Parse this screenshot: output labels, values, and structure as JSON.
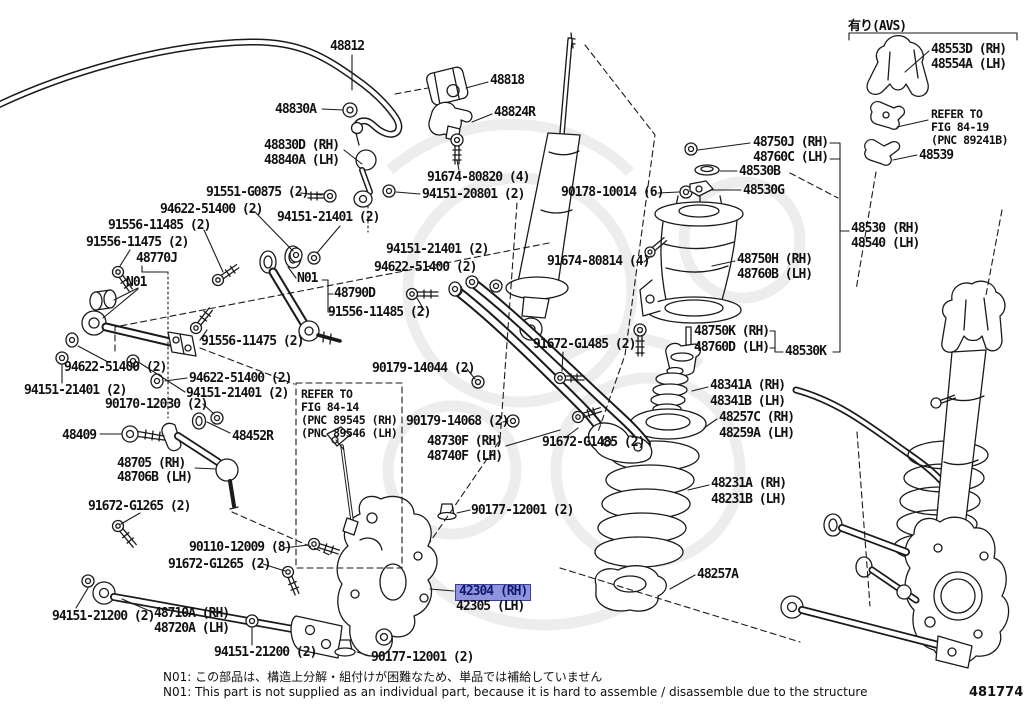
{
  "diagram": {
    "code": "481774G",
    "avs_tag": "有り(AVS)",
    "notes": {
      "jp": "N01: この部品は、構造上分解・組付けが困難なため、単品では補給していません",
      "en": "N01: This part is not supplied as an individual part, because it is hard to assemble / disassemble due to the structure"
    },
    "colors": {
      "line": "#1a1a1a",
      "watermark": "#ededed",
      "highlight_bg": "#8f95dc",
      "highlight_border": "#3a3f9f",
      "highlight_text": "#101870"
    },
    "highlighted_part": "42304 (RH)",
    "labels": [
      {
        "id": "48812",
        "text": "48812",
        "x": 330,
        "y": 40,
        "kind": "part"
      },
      {
        "id": "48818",
        "text": "48818",
        "x": 490,
        "y": 74,
        "kind": "part"
      },
      {
        "id": "48830A",
        "text": "48830A",
        "x": 275,
        "y": 103,
        "kind": "part"
      },
      {
        "id": "48824R",
        "text": "48824R",
        "x": 494,
        "y": 106,
        "kind": "part"
      },
      {
        "id": "48830D",
        "text": "48830D (RH)",
        "x": 264,
        "y": 139,
        "kind": "part"
      },
      {
        "id": "48840A",
        "text": "48840A (LH)",
        "x": 264,
        "y": 154,
        "kind": "part"
      },
      {
        "id": "91674-80820",
        "text": "91674-80820 (4)",
        "x": 427,
        "y": 171,
        "kind": "part"
      },
      {
        "id": "94151-20801",
        "text": "94151-20801 (2)",
        "x": 422,
        "y": 188,
        "kind": "part"
      },
      {
        "id": "91551-G0875",
        "text": "91551-G0875 (2)",
        "x": 206,
        "y": 186,
        "kind": "part"
      },
      {
        "id": "94622-51400-a",
        "text": "94622-51400 (2)",
        "x": 160,
        "y": 203,
        "kind": "part"
      },
      {
        "id": "94151-21401-a",
        "text": "94151-21401 (2)",
        "x": 277,
        "y": 211,
        "kind": "part"
      },
      {
        "id": "91556-11485-a",
        "text": "91556-11485 (2)",
        "x": 108,
        "y": 219,
        "kind": "part"
      },
      {
        "id": "91556-11475-a",
        "text": "91556-11475 (2)",
        "x": 86,
        "y": 236,
        "kind": "part"
      },
      {
        "id": "48770J",
        "text": "48770J",
        "x": 136,
        "y": 252,
        "kind": "part"
      },
      {
        "id": "N01-a",
        "text": "N01",
        "x": 126,
        "y": 276,
        "kind": "note"
      },
      {
        "id": "N01-b",
        "text": "N01",
        "x": 297,
        "y": 272,
        "kind": "note"
      },
      {
        "id": "48790D",
        "text": "48790D",
        "x": 334,
        "y": 287,
        "kind": "part"
      },
      {
        "id": "91556-11485-b",
        "text": "91556-11485 (2)",
        "x": 328,
        "y": 306,
        "kind": "part"
      },
      {
        "id": "94151-21401-b",
        "text": "94151-21401 (2)",
        "x": 386,
        "y": 243,
        "kind": "part"
      },
      {
        "id": "94622-51400-b",
        "text": "94622-51400 (2)",
        "x": 374,
        "y": 261,
        "kind": "part"
      },
      {
        "id": "91556-11475-b",
        "text": "91556-11475 (2)",
        "x": 201,
        "y": 335,
        "kind": "part"
      },
      {
        "id": "94622-51400-c",
        "text": "94622-51400 (2)",
        "x": 64,
        "y": 361,
        "kind": "part"
      },
      {
        "id": "94151-21401-c",
        "text": "94151-21401 (2)",
        "x": 24,
        "y": 384,
        "kind": "part"
      },
      {
        "id": "94622-51400-d",
        "text": "94622-51400 (2)",
        "x": 189,
        "y": 372,
        "kind": "part"
      },
      {
        "id": "94151-21401-d",
        "text": "94151-21401 (2)",
        "x": 186,
        "y": 387,
        "kind": "part"
      },
      {
        "id": "90170-12030",
        "text": "90170-12030 (2)",
        "x": 105,
        "y": 398,
        "kind": "part"
      },
      {
        "id": "48409",
        "text": "48409",
        "x": 62,
        "y": 429,
        "kind": "part"
      },
      {
        "id": "48452R",
        "text": "48452R",
        "x": 232,
        "y": 430,
        "kind": "part"
      },
      {
        "id": "48705",
        "text": "48705 (RH)",
        "x": 117,
        "y": 457,
        "kind": "part"
      },
      {
        "id": "48706B",
        "text": "48706B (LH)",
        "x": 117,
        "y": 471,
        "kind": "part"
      },
      {
        "id": "91672-G1265-a",
        "text": "91672-G1265 (2)",
        "x": 88,
        "y": 500,
        "kind": "part"
      },
      {
        "id": "90110-12009",
        "text": "90110-12009 (8)",
        "x": 189,
        "y": 541,
        "kind": "part"
      },
      {
        "id": "91672-G1265-b",
        "text": "91672-G1265 (2)",
        "x": 168,
        "y": 558,
        "kind": "part"
      },
      {
        "id": "94151-21200-a",
        "text": "94151-21200 (2)",
        "x": 52,
        "y": 610,
        "kind": "part"
      },
      {
        "id": "48710A",
        "text": "48710A (RH)",
        "x": 154,
        "y": 607,
        "kind": "part"
      },
      {
        "id": "48720A",
        "text": "48720A (LH)",
        "x": 154,
        "y": 622,
        "kind": "part"
      },
      {
        "id": "94151-21200-b",
        "text": "94151-21200 (2)",
        "x": 214,
        "y": 646,
        "kind": "part"
      },
      {
        "id": "90177-12001-a",
        "text": "90177-12001 (2)",
        "x": 471,
        "y": 504,
        "kind": "part"
      },
      {
        "id": "42304",
        "text": "42304 (RH)",
        "x": 459,
        "y": 585,
        "kind": "part",
        "highlight": true
      },
      {
        "id": "42305",
        "text": "42305 (LH)",
        "x": 456,
        "y": 600,
        "kind": "part"
      },
      {
        "id": "90177-12001-b",
        "text": "90177-12001 (2)",
        "x": 371,
        "y": 651,
        "kind": "part"
      },
      {
        "id": "refer-84-14-1",
        "text": "REFER TO",
        "x": 301,
        "y": 388,
        "kind": "ref",
        "size": "small"
      },
      {
        "id": "refer-84-14-2",
        "text": "FIG 84-14",
        "x": 301,
        "y": 401,
        "kind": "ref",
        "size": "small"
      },
      {
        "id": "refer-84-14-3",
        "text": "(PNC 89545 (RH)",
        "x": 301,
        "y": 414,
        "kind": "ref",
        "size": "small"
      },
      {
        "id": "refer-84-14-4",
        "text": "(PNC 89546 (LH)",
        "x": 301,
        "y": 427,
        "kind": "ref",
        "size": "small"
      },
      {
        "id": "90179-14044",
        "text": "90179-14044 (2)",
        "x": 372,
        "y": 362,
        "kind": "part"
      },
      {
        "id": "90179-14068",
        "text": "90179-14068 (2)",
        "x": 406,
        "y": 415,
        "kind": "part"
      },
      {
        "id": "48730F",
        "text": "48730F (RH)",
        "x": 427,
        "y": 435,
        "kind": "part"
      },
      {
        "id": "48740F",
        "text": "48740F (LH)",
        "x": 427,
        "y": 450,
        "kind": "part"
      },
      {
        "id": "91672-G1485-a",
        "text": "91672-G1485 (2)",
        "x": 533,
        "y": 338,
        "kind": "part"
      },
      {
        "id": "91672-G1485-b",
        "text": "91672-G1485 (2)",
        "x": 542,
        "y": 436,
        "kind": "part"
      },
      {
        "id": "90178-10014",
        "text": "90178-10014 (6)",
        "x": 561,
        "y": 186,
        "kind": "part"
      },
      {
        "id": "91674-80814",
        "text": "91674-80814 (4)",
        "x": 547,
        "y": 255,
        "kind": "part"
      },
      {
        "id": "48750J",
        "text": "48750J (RH)",
        "x": 753,
        "y": 136,
        "kind": "part"
      },
      {
        "id": "48760C",
        "text": "48760C (LH)",
        "x": 753,
        "y": 151,
        "kind": "part"
      },
      {
        "id": "48530B",
        "text": "48530B",
        "x": 739,
        "y": 165,
        "kind": "part"
      },
      {
        "id": "48530G",
        "text": "48530G",
        "x": 743,
        "y": 184,
        "kind": "part"
      },
      {
        "id": "48530",
        "text": "48530 (RH)",
        "x": 851,
        "y": 222,
        "kind": "part"
      },
      {
        "id": "48540",
        "text": "48540 (LH)",
        "x": 851,
        "y": 237,
        "kind": "part"
      },
      {
        "id": "48750H",
        "text": "48750H (RH)",
        "x": 737,
        "y": 253,
        "kind": "part"
      },
      {
        "id": "48760B",
        "text": "48760B (LH)",
        "x": 737,
        "y": 268,
        "kind": "part"
      },
      {
        "id": "48750K",
        "text": "48750K (RH)",
        "x": 694,
        "y": 325,
        "kind": "part"
      },
      {
        "id": "48760D",
        "text": "48760D (LH)",
        "x": 694,
        "y": 341,
        "kind": "part"
      },
      {
        "id": "48530K",
        "text": "48530K",
        "x": 785,
        "y": 345,
        "kind": "part"
      },
      {
        "id": "48341A",
        "text": "48341A (RH)",
        "x": 710,
        "y": 379,
        "kind": "part"
      },
      {
        "id": "48341B",
        "text": "48341B (LH)",
        "x": 710,
        "y": 395,
        "kind": "part"
      },
      {
        "id": "48257C",
        "text": "48257C (RH)",
        "x": 719,
        "y": 411,
        "kind": "part"
      },
      {
        "id": "48259A",
        "text": "48259A (LH)",
        "x": 719,
        "y": 427,
        "kind": "part"
      },
      {
        "id": "48231A",
        "text": "48231A (RH)",
        "x": 711,
        "y": 477,
        "kind": "part"
      },
      {
        "id": "48231B",
        "text": "48231B (LH)",
        "x": 711,
        "y": 493,
        "kind": "part"
      },
      {
        "id": "48257A",
        "text": "48257A",
        "x": 697,
        "y": 568,
        "kind": "part"
      },
      {
        "id": "avs-tag",
        "text": "有り(AVS)",
        "x": 848,
        "y": 20,
        "kind": "note"
      },
      {
        "id": "48553D",
        "text": "48553D (RH)",
        "x": 931,
        "y": 43,
        "kind": "part"
      },
      {
        "id": "48554A",
        "text": "48554A (LH)",
        "x": 931,
        "y": 58,
        "kind": "part"
      },
      {
        "id": "refer-84-19-1",
        "text": "REFER TO",
        "x": 931,
        "y": 108,
        "kind": "ref",
        "size": "small"
      },
      {
        "id": "refer-84-19-2",
        "text": "FIG 84-19",
        "x": 931,
        "y": 121,
        "kind": "ref",
        "size": "small"
      },
      {
        "id": "refer-84-19-3",
        "text": "(PNC 89241B)",
        "x": 931,
        "y": 134,
        "kind": "ref",
        "size": "small"
      },
      {
        "id": "48539",
        "text": "48539",
        "x": 919,
        "y": 149,
        "kind": "part"
      }
    ]
  }
}
